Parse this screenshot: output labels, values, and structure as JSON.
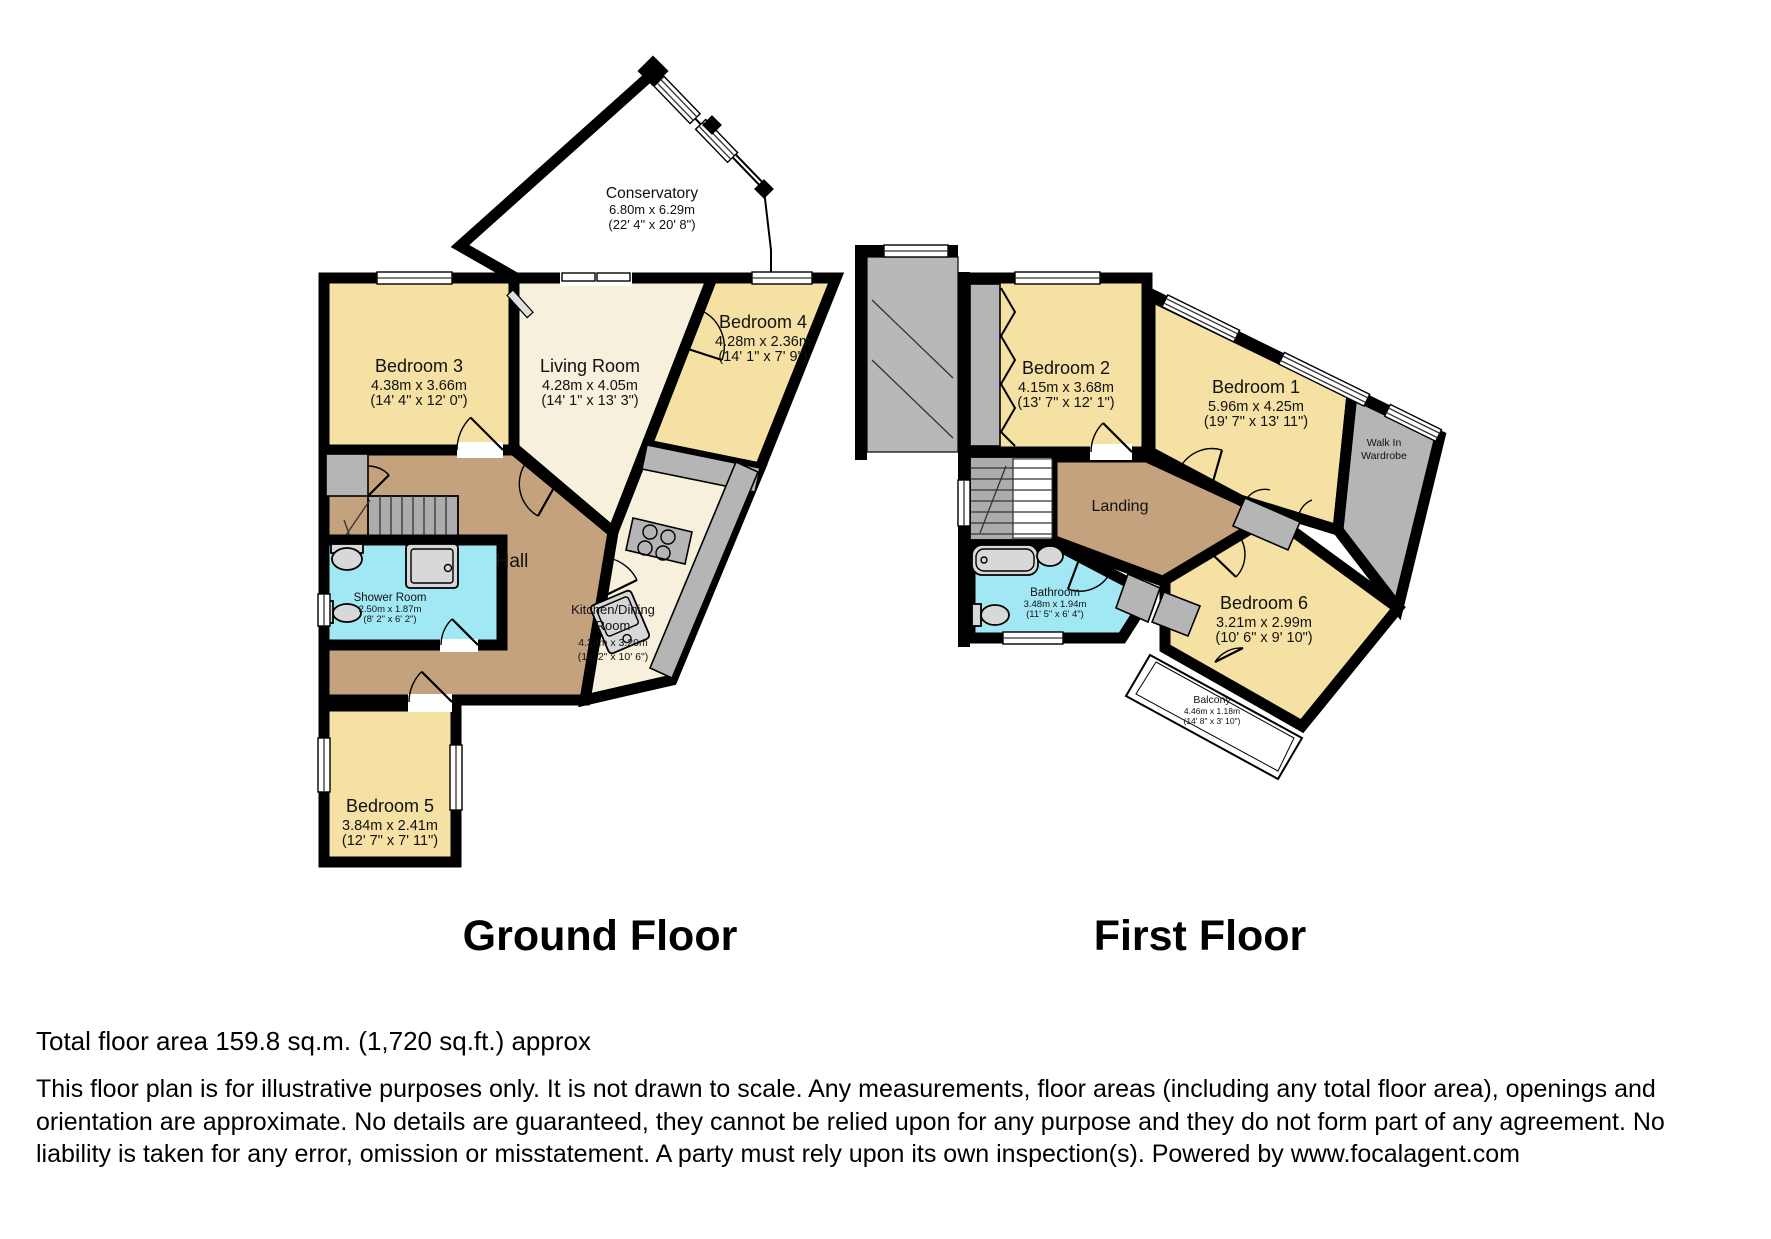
{
  "colors": {
    "wall": "#000000",
    "yellow": "#F5E1A4",
    "cream": "#F7F0DC",
    "brown": "#C4A27E",
    "blue": "#A2E8F4",
    "gray": "#B5B5B5",
    "stair": "#ACACAC",
    "fixture": "#D8D8D8"
  },
  "floors": {
    "ground": {
      "title": "Ground Floor",
      "rooms": {
        "conservatory": {
          "name": "Conservatory",
          "metric": "6.80m x 6.29m",
          "imperial": "(22' 4\" x 20' 8\")"
        },
        "bedroom3": {
          "name": "Bedroom 3",
          "metric": "4.38m x 3.66m",
          "imperial": "(14' 4\" x 12' 0\")"
        },
        "living_room": {
          "name": "Living Room",
          "metric": "4.28m x 4.05m",
          "imperial": "(14' 1\" x 13' 3\")"
        },
        "bedroom4": {
          "name": "Bedroom 4",
          "metric": "4.28m x 2.36m",
          "imperial": "(14' 1\" x 7' 9\")"
        },
        "hall": {
          "name": "Hall"
        },
        "shower_room": {
          "name": "Shower Room",
          "metric": "2.50m x 1.87m",
          "imperial": "(8' 2\" x 6' 2\")"
        },
        "kitchen": {
          "name_line1": "Kitchen/Dining",
          "name_line2": "Room",
          "metric": "4.33m x 3.20m",
          "imperial": "(14' 2\" x 10' 6\")"
        },
        "bedroom5": {
          "name": "Bedroom 5",
          "metric": "3.84m x 2.41m",
          "imperial": "(12' 7\" x 7' 11\")"
        }
      }
    },
    "first": {
      "title": "First Floor",
      "rooms": {
        "bedroom2": {
          "name": "Bedroom 2",
          "metric": "4.15m x 3.68m",
          "imperial": "(13' 7\" x 12' 1\")"
        },
        "bedroom1": {
          "name": "Bedroom 1",
          "metric": "5.96m x 4.25m",
          "imperial": "(19' 7\" x 13' 11\")"
        },
        "walk_in_wardrobe": {
          "line1": "Walk In",
          "line2": "Wardrobe"
        },
        "landing": {
          "name": "Landing"
        },
        "bathroom": {
          "name": "Bathroom",
          "metric": "3.48m x 1.94m",
          "imperial": "(11' 5\" x 6' 4\")"
        },
        "bedroom6": {
          "name": "Bedroom 6",
          "metric": "3.21m x 2.99m",
          "imperial": "(10' 6\" x 9' 10\")"
        },
        "balcony": {
          "name": "Balcony",
          "metric": "4.46m x 1.18m",
          "imperial": "(14' 8\" x 3' 10\")"
        }
      }
    }
  },
  "footer": {
    "total_area": "Total floor area 159.8 sq.m. (1,720 sq.ft.) approx",
    "disclaimer": "This floor plan is for illustrative purposes only. It is not drawn to scale. Any measurements, floor areas (including any total floor area), openings and orientation are approximate. No details are guaranteed, they cannot be relied upon for any purpose and they do not form part of any agreement. No liability is taken for any error, omission or misstatement. A party must rely upon its own inspection(s). Powered by www.focalagent.com"
  }
}
